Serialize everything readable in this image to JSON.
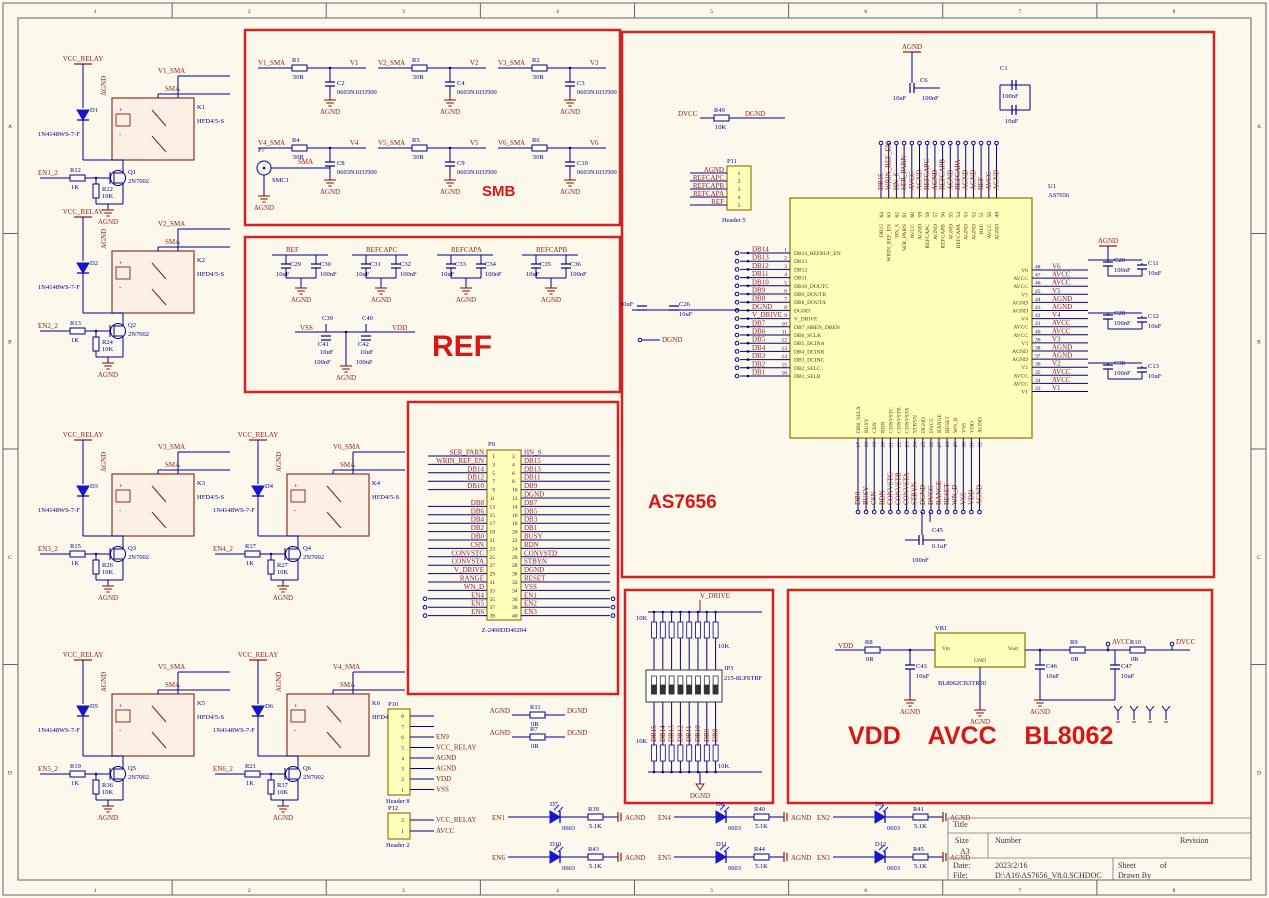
{
  "frame": {
    "cols": [
      "1",
      "2",
      "3",
      "4",
      "5",
      "6",
      "7",
      "8"
    ],
    "rows": [
      "A",
      "B",
      "C",
      "D"
    ]
  },
  "palette": {
    "wire": "#00008b",
    "net": "#8f1d12",
    "box": "#d42222",
    "chip_fill": "#ffffb9",
    "part_fill": "#fcefe6"
  },
  "titles": {
    "smb": "SMB",
    "ref": "REF",
    "as7656": "AS7656",
    "power": "VDD    AVCC    BL8062"
  },
  "relays": [
    {
      "power": "VCC_RELAY",
      "agnd": "AGND",
      "out": "V1_SMA",
      "tap": "SMA",
      "diode": "D1",
      "diode_part": "1N4148WS-7-F",
      "relay": "K1",
      "relay_part": "HFD4/5-S",
      "en": "EN1_2",
      "r_series": "R12",
      "r_series_val": "1K",
      "r_pull": "R22",
      "r_pull_val": "10K",
      "mosfet": "Q1",
      "mosfet_part": "2N7002",
      "gnd": "AGND"
    },
    {
      "power": "VCC_RELAY",
      "agnd": "AGND",
      "out": "V2_SMA",
      "tap": "SMA",
      "diode": "D2",
      "diode_part": "1N4148WS-7-F",
      "relay": "K2",
      "relay_part": "HFD4/5-S",
      "en": "EN2_2",
      "r_series": "R13",
      "r_series_val": "1K",
      "r_pull": "R24",
      "r_pull_val": "10K",
      "mosfet": "Q2",
      "mosfet_part": "2N7002",
      "gnd": "AGND"
    },
    {
      "power": "VCC_RELAY",
      "agnd": "AGND",
      "out": "V3_SMA",
      "tap": "SMA",
      "diode": "D3",
      "diode_part": "1N4148WS-7-F",
      "relay": "K3",
      "relay_part": "HFD4/5-S",
      "en": "EN3_2",
      "r_series": "R15",
      "r_series_val": "1K",
      "r_pull": "R26",
      "r_pull_val": "10K",
      "mosfet": "Q3",
      "mosfet_part": "2N7002",
      "gnd": "AGND"
    },
    {
      "power": "VCC_RELAY",
      "agnd": "AGND",
      "out": "V6_SMA",
      "tap": "SMA",
      "diode": "D4",
      "diode_part": "1N4148WS-7-F",
      "relay": "K4",
      "relay_part": "HFD4/5-S",
      "en": "EN4_2",
      "r_series": "R17",
      "r_series_val": "1K",
      "r_pull": "R27",
      "r_pull_val": "10K",
      "mosfet": "Q4",
      "mosfet_part": "2N7002",
      "gnd": "AGND"
    },
    {
      "power": "VCC_RELAY",
      "agnd": "AGND",
      "out": "V5_SMA",
      "tap": "SMA",
      "diode": "D5",
      "diode_part": "1N4148WS-7-F",
      "relay": "K5",
      "relay_part": "HFD4/5-S",
      "en": "EN5_2",
      "r_series": "R19",
      "r_series_val": "1K",
      "r_pull": "R36",
      "r_pull_val": "10K",
      "mosfet": "Q5",
      "mosfet_part": "2N7002",
      "gnd": "AGND"
    },
    {
      "power": "VCC_RELAY",
      "agnd": "AGND",
      "out": "V4_SMA",
      "tap": "SMA",
      "diode": "D6",
      "diode_part": "1N4148WS-7-F",
      "relay": "K6",
      "relay_part": "HFD4/5-S",
      "en": "EN6_2",
      "r_series": "R21",
      "r_series_val": "1K",
      "r_pull": "R37",
      "r_pull_val": "10K",
      "mosfet": "Q6",
      "mosfet_part": "2N7002",
      "gnd": "AGND"
    }
  ],
  "smb": {
    "jack": {
      "name": "P7",
      "part": "SMC1",
      "net": "SMA",
      "gnd": "AGND"
    },
    "cells": [
      {
        "in": "V1_SMA",
        "r": "R1",
        "rv": "50R",
        "out": "V1",
        "c": "C2",
        "cv": "0603N103J500",
        "gnd": "AGND"
      },
      {
        "in": "V2_SMA",
        "r": "R3",
        "rv": "50R",
        "out": "V2",
        "c": "C4",
        "cv": "0603N103J500",
        "gnd": "AGND"
      },
      {
        "in": "V3_SMA",
        "r": "R2",
        "rv": "50R",
        "out": "V3",
        "c": "C3",
        "cv": "0603N103J500",
        "gnd": "AGND"
      },
      {
        "in": "V4_SMA",
        "r": "R4",
        "rv": "50R",
        "out": "V4",
        "c": "C8",
        "cv": "0603N103J500",
        "gnd": "AGND"
      },
      {
        "in": "V5_SMA",
        "r": "R5",
        "rv": "50R",
        "out": "V5",
        "c": "C9",
        "cv": "0603N103J500",
        "gnd": "AGND"
      },
      {
        "in": "V6_SMA",
        "r": "R6",
        "rv": "50R",
        "out": "V6",
        "c": "C10",
        "cv": "0603N103J500",
        "gnd": "AGND"
      }
    ]
  },
  "ref": {
    "cells": [
      {
        "net": "REF",
        "c1": "C29",
        "v1": "10uF",
        "c2": "C30",
        "v2": "100nF",
        "gnd": "AGND"
      },
      {
        "net": "REFCAPC",
        "c1": "C31",
        "v1": "10uF",
        "c2": "C32",
        "v2": "100nF",
        "gnd": "AGND"
      },
      {
        "net": "REFCAPA",
        "c1": "C33",
        "v1": "10uF",
        "c2": "C34",
        "v2": "100nF",
        "gnd": "AGND"
      },
      {
        "net": "REFCAPB",
        "c1": "C35",
        "v1": "10uF",
        "c2": "C36",
        "v2": "100nF",
        "gnd": "AGND"
      }
    ],
    "rail": {
      "left": "VSS",
      "right": "VDD",
      "c_top1": "C39",
      "c_in1": "C41",
      "v_in1": "10uF",
      "v_bot1": "100nF",
      "c_top2": "C40",
      "c_in2": "C42",
      "v_in2": "10uF",
      "v_bot2": "100nF",
      "gnd": "AGND"
    }
  },
  "conn": {
    "name": "P9",
    "part": "Z-2490DD40204",
    "rows": [
      [
        1,
        "SER_PARN",
        2,
        "HN_S"
      ],
      [
        3,
        "WRIN_REF_EN",
        4,
        "DB15"
      ],
      [
        5,
        "DB14",
        6,
        "DB13"
      ],
      [
        7,
        "DB12",
        8,
        "DB11"
      ],
      [
        9,
        "DB10",
        10,
        "DB9"
      ],
      [
        11,
        "",
        12,
        "DGND"
      ],
      [
        13,
        "DB8",
        14,
        "DB7"
      ],
      [
        15,
        "DB6",
        16,
        "DB5"
      ],
      [
        17,
        "DB4",
        18,
        "DB3"
      ],
      [
        19,
        "DB2",
        20,
        "DB1"
      ],
      [
        21,
        "DB0",
        22,
        "BUSY"
      ],
      [
        23,
        "CSN",
        24,
        "RDN"
      ],
      [
        25,
        "CONVSTC",
        26,
        "CONVSTD"
      ],
      [
        27,
        "CONVSTA",
        28,
        "STBYN"
      ],
      [
        29,
        "V_DRIVE",
        30,
        "DGND"
      ],
      [
        31,
        "RANGE",
        32,
        "RESET"
      ],
      [
        33,
        "WN_D",
        34,
        "VSS"
      ],
      [
        35,
        "EN4",
        36,
        "EN1"
      ],
      [
        37,
        "EN5",
        38,
        "EN2"
      ],
      [
        39,
        "EN6",
        40,
        "EN3"
      ]
    ]
  },
  "as7656": {
    "pullup": {
      "a": "DVCC",
      "r": "R49",
      "v": "10K",
      "b": "DGND"
    },
    "header": {
      "name": "P11",
      "part": "Header 5",
      "pins": [
        "AGND",
        "REFCAPC",
        "REFCAPB",
        "REFCAPA",
        "REF"
      ]
    },
    "chip": {
      "ref": "U1",
      "part": "AS7656",
      "left": [
        [
          1,
          "DB14_REFBUF_EN",
          "DB14"
        ],
        [
          2,
          "DB13",
          "DB13"
        ],
        [
          3,
          "DB12",
          "DB12"
        ],
        [
          4,
          "DB11",
          "DB11"
        ],
        [
          5,
          "DB10_DOUTC",
          "DB10"
        ],
        [
          6,
          "DB9_DOUTB",
          "DB9"
        ],
        [
          7,
          "DB8_DOUTA",
          "DB8"
        ],
        [
          8,
          "DGND",
          "DGND"
        ],
        [
          9,
          "V_DRIVE",
          "V_DRIVE"
        ],
        [
          10,
          "DB7_HBEN_DBEN",
          "DB7"
        ],
        [
          11,
          "DB6_SCLK",
          "DB6"
        ],
        [
          12,
          "DB5_DCINA",
          "DB5"
        ],
        [
          13,
          "DB4_DCINB",
          "DB4"
        ],
        [
          14,
          "DB3_DCINC",
          "DB3"
        ],
        [
          15,
          "DB2_SELC",
          "DB2"
        ],
        [
          16,
          "DB1_SELB",
          "DB1"
        ]
      ],
      "top": [
        [
          64,
          "DB15"
        ],
        [
          63,
          "WRIN_REF_EN"
        ],
        [
          62,
          "HN_S"
        ],
        [
          61,
          "SER_PARN"
        ],
        [
          60,
          "AVCC"
        ],
        [
          59,
          "AGND"
        ],
        [
          58,
          "REFCAPC"
        ],
        [
          57,
          "AGND"
        ],
        [
          56,
          "REFCAPB"
        ],
        [
          55,
          "AGND"
        ],
        [
          54,
          "REFCAPA"
        ],
        [
          53,
          "AGND"
        ],
        [
          52,
          "AGND"
        ],
        [
          51,
          "REF"
        ],
        [
          50,
          "AVCC"
        ],
        [
          49,
          "AGND"
        ]
      ],
      "right": [
        [
          48,
          "V6"
        ],
        [
          47,
          "AVCC"
        ],
        [
          46,
          "AVCC"
        ],
        [
          45,
          "V5"
        ],
        [
          44,
          "AGND"
        ],
        [
          43,
          "AGND"
        ],
        [
          42,
          "V4"
        ],
        [
          41,
          "AVCC"
        ],
        [
          40,
          "AVCC"
        ],
        [
          39,
          "V3"
        ],
        [
          38,
          "AGND"
        ],
        [
          37,
          "AGND"
        ],
        [
          36,
          "V2"
        ],
        [
          35,
          "AVCC"
        ],
        [
          34,
          "AVCC"
        ],
        [
          33,
          "V1"
        ]
      ],
      "bottom": [
        [
          17,
          "DB0_SELA",
          "DB0"
        ],
        [
          18,
          "BUSY",
          "BUSY"
        ],
        [
          19,
          "CSN",
          "CSN"
        ],
        [
          20,
          "RDN",
          "RDN"
        ],
        [
          21,
          "CONVSTC",
          "CONVSTC"
        ],
        [
          22,
          "CONVSTB",
          "CONVSTB"
        ],
        [
          23,
          "CONVSTA",
          "CONVSTA"
        ],
        [
          24,
          "STBYN",
          "STBYN"
        ],
        [
          25,
          "DGND",
          "DGND"
        ],
        [
          26,
          "DVCC",
          "DVCC"
        ],
        [
          27,
          "RANGE",
          "RANGE"
        ],
        [
          28,
          "RESET",
          "RESET"
        ],
        [
          29,
          "WN_B",
          "WN_D"
        ],
        [
          30,
          "VSS",
          "VSS"
        ],
        [
          31,
          "VDD",
          "VDD"
        ],
        [
          32,
          "AGND",
          "AGND"
        ]
      ]
    },
    "caps": {
      "top1": [
        "C6",
        "10uF",
        "100nF"
      ],
      "top1_gnd": "AGND",
      "top2": [
        "C1",
        "100nF",
        "10uF"
      ],
      "left": [
        "10uF",
        "C26",
        "10uF"
      ],
      "left_net": "DGND",
      "right": [
        [
          "C20",
          "100nF",
          "C11",
          "10uF"
        ],
        [
          "C28",
          "100nF",
          "C12",
          "10uF"
        ],
        [
          "C38",
          "100nF",
          "C13",
          "10uF"
        ]
      ],
      "right_gnd": "AGND",
      "bottom": [
        "C45",
        "0.1uF",
        "100nF"
      ]
    }
  },
  "vdrive": {
    "net": "V_DRIVE",
    "gnd": "DGND",
    "top_row": {
      "count": 8,
      "val": "10K"
    },
    "bot_row": {
      "count": 8,
      "val": "10K"
    },
    "switch": {
      "name": "JP3",
      "part": "215-8LPSTRF"
    },
    "nets": [
      "DB15",
      "DB14",
      "DB13",
      "DB12",
      "DB11",
      "DB10",
      "DB9",
      "DB8"
    ]
  },
  "bl": {
    "in": "VDD",
    "r_in": "R8",
    "r_in_v": "0R",
    "c_in": "C43",
    "c_in_v": "10uF",
    "vr": {
      "ref": "VR1",
      "vin": "Vin",
      "vout": "Vout",
      "gnd": "GND",
      "part": "BL8062CB3TR50"
    },
    "c_out": "C46",
    "c_out_v": "10uF",
    "r_mid": "R9",
    "r_mid_v": "0R",
    "net_mid": "AVCC",
    "c_mid": "C47",
    "c_mid_v": "10uF",
    "r_out": "R10",
    "r_out_v": "0R",
    "net_out": "DVCC",
    "gnd": "AGND"
  },
  "leds": {
    "gnd": "AGND",
    "rows": [
      [
        {
          "en": "EN1",
          "d": "D7",
          "fp": "0603",
          "r": "R39",
          "rv": "5.1K"
        },
        {
          "en": "EN4",
          "d": "D8",
          "fp": "0603",
          "r": "R40",
          "rv": "5.1K"
        },
        {
          "en": "EN2",
          "d": "D9",
          "fp": "0603",
          "r": "R41",
          "rv": "5.1K"
        }
      ],
      [
        {
          "en": "EN6",
          "d": "D10",
          "fp": "0603",
          "r": "R43",
          "rv": "5.1K"
        },
        {
          "en": "EN5",
          "d": "D11",
          "fp": "0603",
          "r": "R44",
          "rv": "5.1K"
        },
        {
          "en": "EN3",
          "d": "D12",
          "fp": "0603",
          "r": "R45",
          "rv": "5.1K"
        }
      ]
    ]
  },
  "headers": {
    "p10": {
      "name": "P10",
      "part": "Header 8",
      "pins": [
        {
          "n": 8,
          "l": ""
        },
        {
          "n": 7,
          "l": ""
        },
        {
          "n": 6,
          "l": "EN9"
        },
        {
          "n": 5,
          "l": "VCC_RELAY"
        },
        {
          "n": 4,
          "l": "AGND"
        },
        {
          "n": 3,
          "l": "AGND"
        },
        {
          "n": 2,
          "l": "VDD"
        },
        {
          "n": 1,
          "l": "VSS"
        }
      ]
    },
    "p12": {
      "name": "P12",
      "part": "Header 2",
      "pins": [
        {
          "n": 2,
          "l": "VCC_RELAY"
        },
        {
          "n": 1,
          "l": "AVCC"
        }
      ]
    },
    "jumpers": [
      {
        "a": "AGND",
        "r": "R11",
        "v": "0R",
        "b": "DGND"
      },
      {
        "a": "AGND",
        "r": "R7",
        "v": "0R",
        "b": "DGND"
      }
    ]
  },
  "titleblock": {
    "title_label": "Title",
    "size_label": "Size",
    "size_value": "A3",
    "number_label": "Number",
    "revision_label": "Revision",
    "date_label": "Date:",
    "date_value": "2023/2/16",
    "file_label": "File:",
    "file_value": "D:\\A16\\AS7656_V8.0.SCHDOC",
    "sheet_label": "Sheet",
    "of_label": "of",
    "drawnby_label": "Drawn By"
  }
}
